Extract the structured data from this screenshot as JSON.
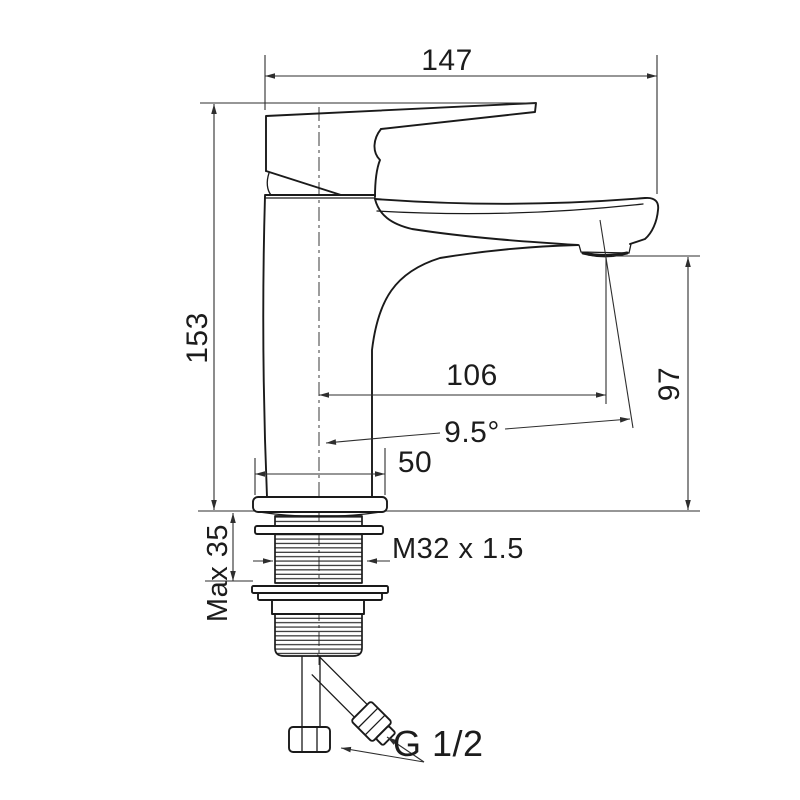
{
  "drawing": {
    "subject": "single-lever basin mixer faucet — dimensioned side elevation",
    "background_color": "#ffffff",
    "line_color": "#1a1a1a",
    "dimensions": {
      "overall_length": "147",
      "overall_height": "153",
      "spout_reach": "106",
      "spout_outlet_height": "97",
      "spray_angle": "9.5°",
      "base_width": "50",
      "max_mounting_thickness": "Max 35",
      "shank_thread": "M32 x 1.5",
      "hose_thread": "G 1/2"
    }
  }
}
